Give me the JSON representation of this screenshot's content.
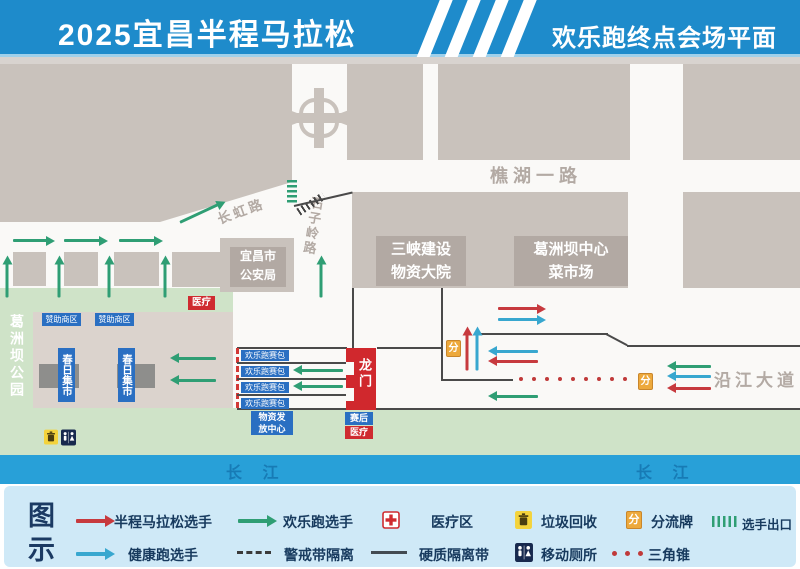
{
  "header": {
    "title_left": "2025宜昌半程马拉松",
    "title_right": "欢乐跑终点会场平面图"
  },
  "map": {
    "roads": {
      "qiaohu_yilu": "樵湖一路",
      "changhong_lu": "长虹路",
      "shiziling_lu": "石子岭路",
      "yanjiang_dadao": "沿江大道",
      "changjiang": "长 江"
    },
    "buildings": {
      "police_lines": [
        "宜昌市",
        "公安局"
      ],
      "sanxia_lines": [
        "三峡建设",
        "物资大院"
      ],
      "market_lines": [
        "葛洲坝中心",
        "菜市场"
      ]
    },
    "park": {
      "name": "葛洲坝公园",
      "spring_market": "春日集市",
      "vendor_tag": "赞助商区",
      "medical": "医疗"
    },
    "finish": {
      "gate": "龙门",
      "chute_label": "欢乐跑赛包",
      "supply_lines": [
        "物资发",
        "放中心"
      ],
      "post_race_blue": "赛后",
      "post_race_red": "医疗"
    },
    "signs": {
      "divert": "分"
    }
  },
  "legend": {
    "title_lines": [
      "图",
      "示"
    ],
    "row1": [
      {
        "icon": "red-arrow",
        "label": "半程马拉松选手"
      },
      {
        "icon": "green-arrow",
        "label": "欢乐跑选手"
      },
      {
        "icon": "medical-cross",
        "label": "医疗区"
      },
      {
        "icon": "trash",
        "label": "垃圾回收"
      },
      {
        "icon": "divert-sign",
        "label": "分流牌"
      },
      {
        "icon": "exit-hatch",
        "label": "选手出口"
      }
    ],
    "row2": [
      {
        "icon": "blue-arrow",
        "label": "健康跑选手"
      },
      {
        "icon": "dashed-line",
        "label": "警戒带隔离"
      },
      {
        "icon": "solid-line",
        "label": "硬质隔离带"
      },
      {
        "icon": "toilet",
        "label": "移动厕所"
      },
      {
        "icon": "red-dots",
        "label": "三角锥"
      }
    ]
  },
  "colors": {
    "header_blue": "#1e8bcb",
    "river_blue": "#28a0d8",
    "runner_red": "#c73a3e",
    "runner_green": "#2f9e74",
    "runner_blue": "#38a7cf",
    "sign_yellow": "#eda93c",
    "building_gray": "#c9c2bc",
    "park_green": "#cfe3c8",
    "legend_bg": "#cfe9f7"
  }
}
